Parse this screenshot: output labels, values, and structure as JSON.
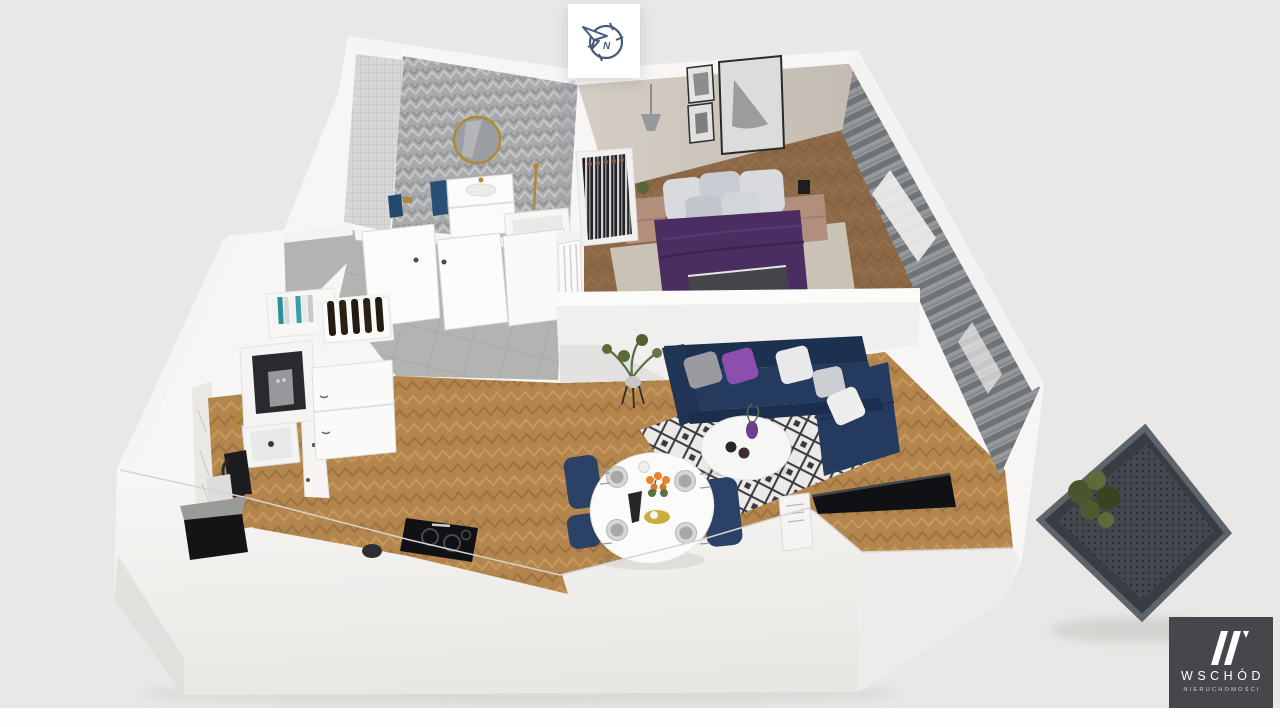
{
  "page": {
    "background": "#e9e8e6",
    "footer": "#fdfdfd"
  },
  "compass": {
    "label": "N",
    "icon": "compass-north-icon",
    "color": "#47597c"
  },
  "brand": {
    "name": "WSCHÓD",
    "subtitle": "NIERUCHOMOŚCI",
    "mark": "double-slash-monogram-icon",
    "background": "#45474b",
    "text_color": "#ffffff"
  },
  "scene": {
    "type": "3d-floorplan-render",
    "rooms": [
      {
        "name": "bathroom",
        "features": [
          "chevron-tile-wall",
          "mosaic-tile-wall",
          "round-gold-mirror",
          "white-vanity",
          "bathtub",
          "gold-shower-set",
          "blue-towel"
        ]
      },
      {
        "name": "bedroom",
        "features": [
          "double-bed-purple-duvet",
          "gray-pillows",
          "two-nightstands",
          "pendant-lamp",
          "framed-artworks",
          "open-wardrobe-hangers",
          "area-rug",
          "gray-curtains"
        ]
      },
      {
        "name": "living-room",
        "features": [
          "navy-corner-sofa",
          "accent-pillows",
          "round-coffee-table",
          "geometric-rug",
          "tv-panel",
          "side-table",
          "potted-plant"
        ]
      },
      {
        "name": "dining-area",
        "features": [
          "oval-white-table",
          "four-place-settings",
          "orange-tulips",
          "navy-chairs"
        ]
      },
      {
        "name": "kitchen",
        "features": [
          "white-cabinets",
          "wood-countertop",
          "sink-gold-faucet",
          "coffee-machine",
          "wine-rack",
          "cookbooks",
          "induction-hob",
          "black-kettle"
        ]
      },
      {
        "name": "hallway",
        "features": [
          "gray-tile-floor",
          "white-doors",
          "radiator"
        ]
      },
      {
        "name": "balcony",
        "features": [
          "dark-perforated-floor",
          "planter"
        ]
      }
    ],
    "colors": {
      "wall_white": "#f7f6f4",
      "wall_shadow": "#e3e2e0",
      "tile_floor": "#b3b4b2",
      "wood_floor": "#b5854e",
      "wood_dark": "#9c7240",
      "chevron_wall": "#a9aaac",
      "mosaic_wall": "#d7d7d5",
      "bedroom_wall": "#cdc6bd",
      "bed_duvet": "#4b2e61",
      "pillow_accent": "#8d4fae",
      "nightstand": "#b28e7d",
      "rug_bedroom": "#cec7ba",
      "sofa": "#243a5e",
      "sofa_dark": "#1c3050",
      "rug_living": "#eceae6",
      "rug_pattern": "#383840",
      "curtain": "#95999c",
      "curtain_dark": "#6f7377",
      "dining_chair": "#2b4266",
      "flower": "#e8832e",
      "gold": "#b08a33",
      "tv": "#101114",
      "balcony": "#43484e",
      "balcony_dot": "#272b30",
      "plant": "#5c6b3a"
    }
  }
}
